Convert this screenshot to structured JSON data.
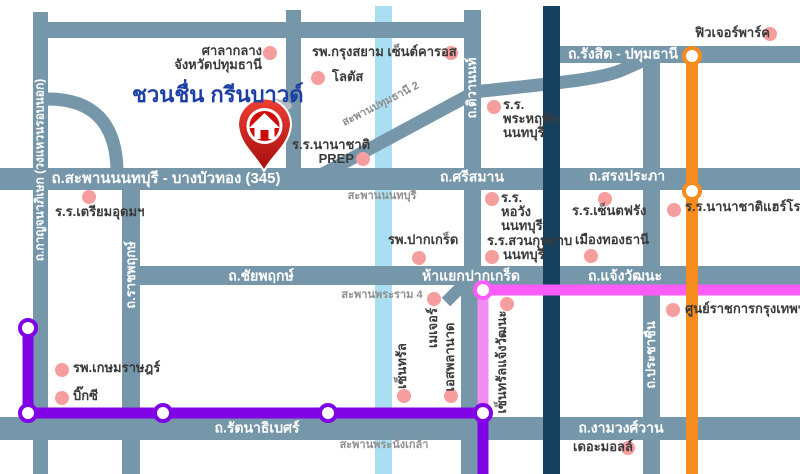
{
  "title": {
    "text": "ชวนชื่น กรีนบาวด์"
  },
  "road_labels": {
    "route345": "ถ.สะพานนนทบุรี - บางบัวทอง (345)",
    "srisaman": "ถ.ศรีสมาน",
    "songprapha": "ถ.สรงประภา",
    "rangsit": "ถ.รังสิต - ปทุมธานี",
    "chaiyaphruek": "ถ.ชัยพฤกษ์",
    "hayaek_pakkret": "ห้าแยกปากเกร็ด",
    "chaengwatthana": "ถ.แจ้งวัฒนะ",
    "rattanathibet": "ถ.รัตนาธิเบศร์",
    "ngamwongwan": "ถ.งามวงศ์วาน",
    "kanchanaphisek": "ถ.กาญจนาภิเษก (วงแหวนรอบนอก)",
    "ratchaphruek": "ถ.ราชพฤกษ์",
    "tiwanon": "ถ.ติวานนท์",
    "prachachuen": "ถ.ประชาชื่น"
  },
  "bridge_labels": {
    "pathumthani2": "สะพานปทุมธานี 2",
    "nonthaburi": "สะพานนนทบุรี",
    "rama4": "สะพานพระราม 4",
    "phranangklao": "สะพานพระนั่งเกล้า"
  },
  "landmarks": {
    "city_hall_1": "ศาลากลาง",
    "city_hall_2": "จังหวัดปทุมธานี",
    "krungsiam": "รพ.กรุงสยาม เซ็นต์คารอส",
    "lotus": "โลตัส",
    "prep_1": "ร.ร.นานาชาติ",
    "prep_2": "PREP",
    "triamudom": "ร.ร.เตรียมอุดมฯ",
    "phraharuthai_1": "ร.ร.",
    "phraharuthai_2": "พระหฤทัย",
    "phraharuthai_3": "นนทบุรี",
    "future_park": "ฟิวเจอร์พาร์ค",
    "horwang_1": "ร.ร.",
    "horwang_2": "หอวัง",
    "horwang_3": "นนทบุรี",
    "stfrancis": "ร.ร.เซ็นตฟรัง",
    "harrow": "ร.ร.นานาชาติแฮร์โรว์",
    "muangthong": "เมืองทองธานี",
    "suankularb_1": "ร.ร.สวนกุหลาบ",
    "suankularb_2": "นนทบุรี",
    "pakkret_hospital": "รพ.ปากเกร็ด",
    "central": "เซ็นทรัล",
    "major": "เมเจอร์",
    "esplanade": "เอสพลานาด",
    "central_chaengwatthana": "เซ็นทรัลแจ้งวัฒนะ",
    "government_complex": "ศูนย์ราชการกรุงเทพฯ",
    "kasemrad": "รพ.เกษมราษฎร์",
    "bigc": "บิ๊กซี",
    "the_mall": "เดอะมอลล์"
  },
  "colors": {
    "road_teal": "#7697aa",
    "expressway_navy": "#16415e",
    "river_lightblue": "#aadff1",
    "line_orange": "#f68b1e",
    "line_purple": "#8003e6",
    "line_pink": "#fb5cf7",
    "line_pink_light": "#f08cf2",
    "landmark_dot_pink": "#f69d9d",
    "title_blue": "#1c3fa5",
    "pin_red": "#cf0a0a"
  }
}
